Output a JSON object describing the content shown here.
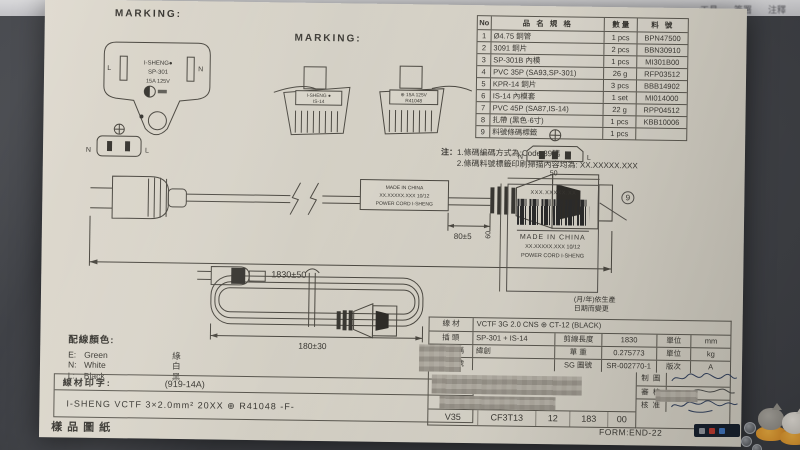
{
  "toolbar": {
    "items": [
      "工具",
      "簽署",
      "注釋"
    ]
  },
  "doc": {
    "marking_label_1": "MARKING:",
    "marking_label_2": "MARKING:",
    "plug_face": {
      "l": "L",
      "n": "N",
      "brand": "I-SHENG●",
      "model": "SP-301",
      "rating": "15A 125V"
    },
    "conn_marking": {
      "label1_l1": "I-SHENG ●",
      "label1_l2": "IS-14",
      "label2_l1": "⊕ 15A 125V",
      "label2_l2": "R41048"
    },
    "bom": {
      "h_no": "No",
      "h_name": "品 名 規 格",
      "h_qty": "數 量",
      "h_pn": "料 號",
      "rows": [
        [
          "1",
          "Ø4.75 銅管",
          "1 pcs",
          "BPN47500"
        ],
        [
          "2",
          "3091 銅片",
          "2 pcs",
          "BBN30910"
        ],
        [
          "3",
          "SP-301B 內模",
          "1 pcs",
          "MI301B00"
        ],
        [
          "4",
          "PVC 35P (SA93,SP-301)",
          "26 g",
          "RFP03512"
        ],
        [
          "5",
          "KPR-14 銅片",
          "3 pcs",
          "BBB14902"
        ],
        [
          "6",
          "IS-14 內模套",
          "1 set",
          "MI014000"
        ],
        [
          "7",
          "PVC 45P (SA87,IS-14)",
          "22 g",
          "RPP04512"
        ],
        [
          "8",
          "扎帶 (黑色·6寸)",
          "1 pcs",
          "KBB10006"
        ],
        [
          "9",
          "料號條碼標籤",
          "1 pcs",
          ""
        ]
      ]
    },
    "notes": {
      "prefix": "注：",
      "l1": "1.條碼編碼方式為:Code 39碼",
      "l2": "2.條碼料號標籤印刷掃描內容均為: XX.XXXXX.XXX"
    },
    "main_view": {
      "front_n": "N",
      "front_l": "L",
      "conn_front_n": "N",
      "conn_front_l": "L",
      "flag_l1": "MADE IN CHINA",
      "flag_l2": "XX.XXXXX.XXX  10/12",
      "flag_l3": "POWER CORD I-SHENG",
      "dim_80": "80±5",
      "dim_1830": "1830±50"
    },
    "label_box": {
      "dim_w": "50",
      "dim_h": "60",
      "l1": "XXX.XXXXX.XX",
      "l2": "MADE IN CHINA",
      "l3": "XX.XXXXX.XXX  10/12",
      "l4": "POWER CORD I-SHENG",
      "callout": "9",
      "note1": "(月/年)依生產",
      "note2": "日期而變更"
    },
    "coil": {
      "dim": "180±30"
    },
    "wire_colors": {
      "title": "配線顏色:",
      "rows": [
        [
          "E:",
          "Green",
          "綠"
        ],
        [
          "N:",
          "White",
          "白"
        ],
        [
          "L:",
          "Black",
          "黑"
        ]
      ]
    },
    "print": {
      "label": "線材印字:",
      "code": "(919-14A)",
      "line": "I-SHENG   VCTF   3×2.0mm²   20XX   ⊕ R41048   -F-"
    },
    "sheet_title": "樣品圖紙",
    "spec": {
      "wire_label": "線 材",
      "wire_value": "VCTF 3G 2.0 CNS ⊕ CT-12 (BLACK)",
      "plug_label": "插 頭",
      "plug_value": "SP-301 + IS-14",
      "cut_label": "剪線長度",
      "cut_value": "1830",
      "unit1_label": "單位",
      "unit1": "mm",
      "cust_top": "客",
      "cust_bottom": "戶",
      "name_label": "名稱",
      "name_value": "緯創",
      "weight_label": "單 重",
      "weight_value": "0.275773",
      "unit2_label": "單位",
      "unit2": "kg",
      "pn_label": "料號",
      "pn_value": "",
      "sg_label": "SG 圖號",
      "sg_value": "SR-002770-1",
      "rev_label": "版次",
      "rev_value": "A",
      "draw_label": "制 圖",
      "check_label": "審 核",
      "approve_label": "核 准"
    },
    "codes": [
      "V35",
      "CF3T13",
      "12",
      "183",
      "00"
    ],
    "form_no": "FORM:END-22"
  }
}
